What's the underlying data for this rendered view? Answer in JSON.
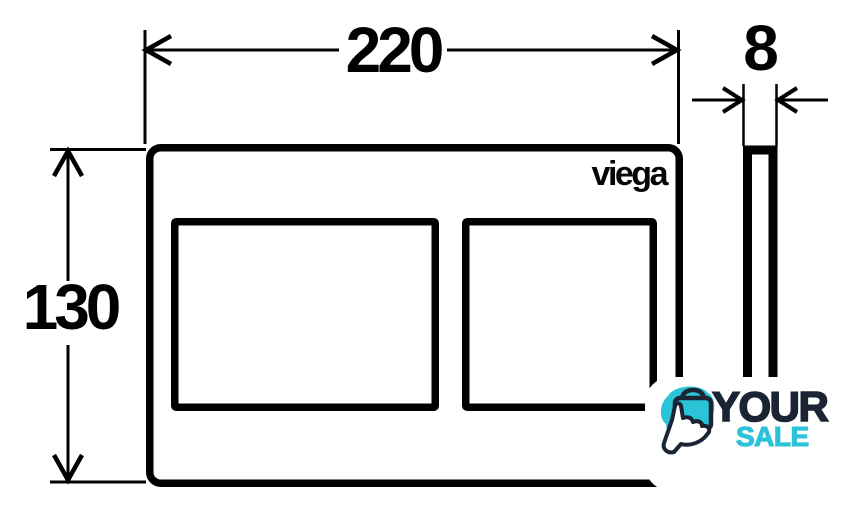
{
  "drawing": {
    "width_label": "220",
    "height_label": "130",
    "depth_label": "8",
    "brand_logo": "viega",
    "line_color": "#000000",
    "background_color": "#ffffff",
    "views": {
      "front": "flush-plate-front-view-with-two-buttons",
      "side": "flush-plate-side-profile-view"
    }
  },
  "watermark": {
    "word_top": "YOUR",
    "word_bottom": "SALE",
    "navy_color": "#1b2433",
    "teal_color": "#2bc3d8",
    "icon": "shopping-bag-click-icon"
  }
}
